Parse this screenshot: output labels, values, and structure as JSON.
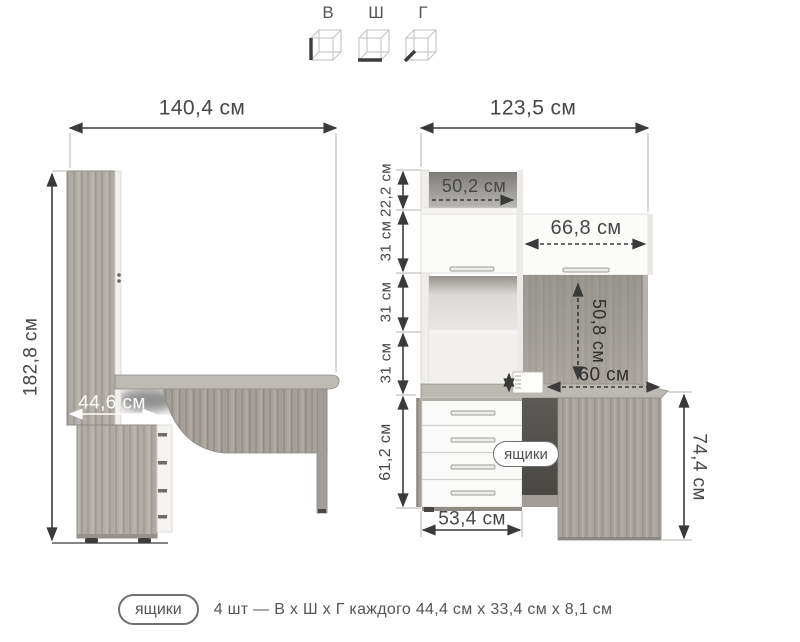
{
  "legend": {
    "items": [
      {
        "label": "В",
        "icon": "cube-height-icon"
      },
      {
        "label": "Ш",
        "icon": "cube-width-icon"
      },
      {
        "label": "Г",
        "icon": "cube-depth-icon"
      }
    ]
  },
  "left_view": {
    "width": "140,4 см",
    "height": "182,8 см",
    "lower_depth": "44,6 см"
  },
  "right_view": {
    "width": "123,5 см",
    "left_chain": [
      {
        "label": "22,2 см"
      },
      {
        "label": "31 см"
      },
      {
        "label": "31 см"
      },
      {
        "label": "31 см"
      },
      {
        "label": "61,2 см"
      }
    ],
    "shelf_depth": "50,2 см",
    "door_width": "66,8 см",
    "back_height": "50,8 см",
    "desk_depth": "60 см",
    "drawers_width": "53,4 см",
    "desk_height": "74,4 см",
    "drawers_badge": "ящики"
  },
  "caption": {
    "badge": "ящики",
    "text": "4 шт — В х Ш х Г каждого 44,4 см х 33,4 см х 8,1 см"
  },
  "colors": {
    "wood": "#aeaaa3",
    "wood_dark": "#8d8a85",
    "front_white": "#fafaf9",
    "dimension_line": "#3a3a3a"
  }
}
